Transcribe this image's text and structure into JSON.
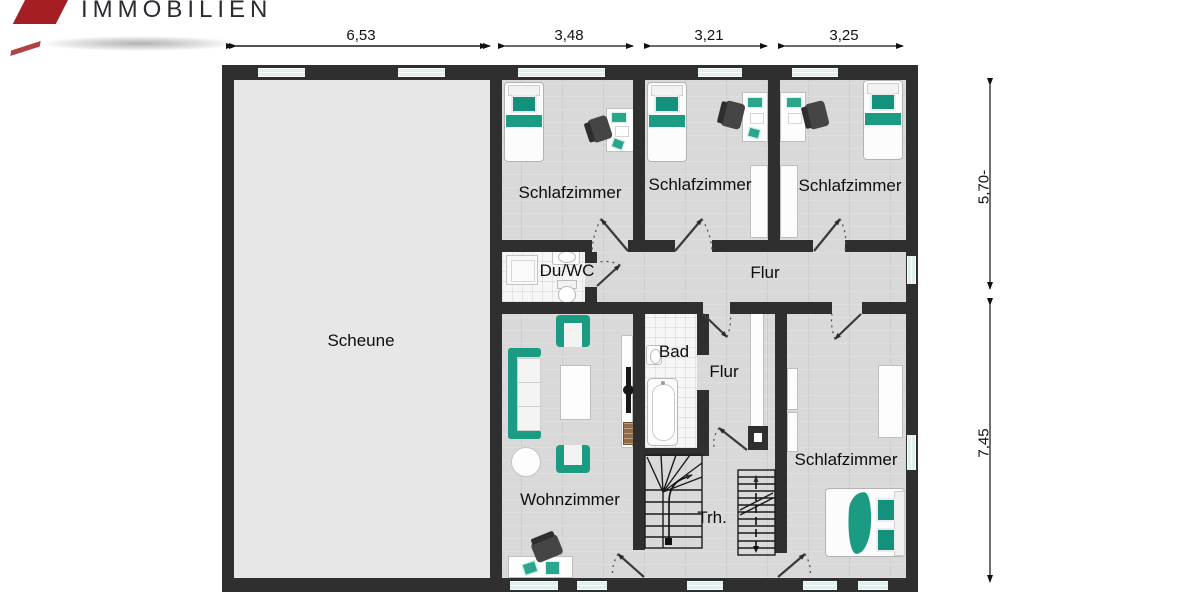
{
  "brand": {
    "name": "IMMOBILIEN"
  },
  "floorplan": {
    "rooms": [
      {
        "id": "scheune",
        "label": "Scheune"
      },
      {
        "id": "schlafzimmer-top-left",
        "label": "Schlafzimmer"
      },
      {
        "id": "schlafzimmer-top-middle",
        "label": "Schlafzimmer"
      },
      {
        "id": "schlafzimmer-top-right",
        "label": "Schlafzimmer"
      },
      {
        "id": "du-wc",
        "label": "Du/WC"
      },
      {
        "id": "flur-upper",
        "label": "Flur"
      },
      {
        "id": "wohnzimmer",
        "label": "Wohnzimmer"
      },
      {
        "id": "bad",
        "label": "Bad"
      },
      {
        "id": "flur-lower",
        "label": "Flur"
      },
      {
        "id": "treppenhaus",
        "label": "Trh."
      },
      {
        "id": "schlafzimmer-bottom",
        "label": "Schlafzimmer"
      }
    ],
    "dimensions": {
      "top": [
        "6,53",
        "3,48",
        "3,21",
        "3,25"
      ],
      "right": [
        "5,70-",
        "7,45"
      ]
    }
  },
  "colors": {
    "brand_red": "#a51e23",
    "wall": "#2f2f2f",
    "accent_teal": "#1b9b81",
    "window_glass": "#dff0ef"
  }
}
